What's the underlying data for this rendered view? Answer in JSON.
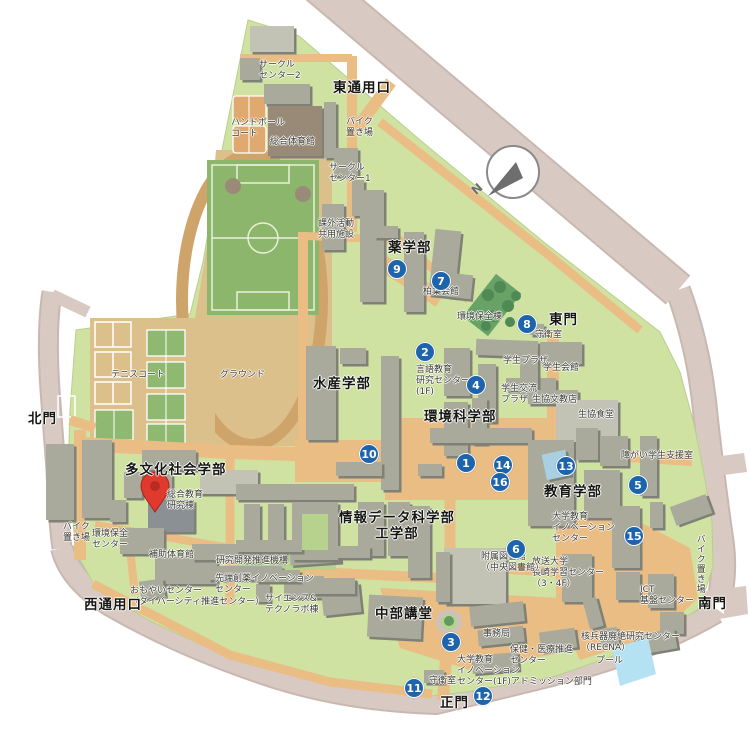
{
  "colors": {
    "campus_green": "#cfe2a2",
    "court_green": "#8fb971",
    "field_green": "#8cb66b",
    "tree_green": "#5f9a60",
    "path_orange": "#eabd84",
    "ground_tan": "#dcc08c",
    "track_tan": "#cfa46a",
    "road_pink": "#d8c9c2",
    "building_gray": "#a9aa9b",
    "marker_blue": "#1e64ad",
    "pin_red": "#e03a2f",
    "pool_blue": "#b5e2f2"
  },
  "compass": {
    "label": "N"
  },
  "pin": {
    "target": "総合教育研究棟"
  },
  "markers": [
    {
      "n": "1",
      "x": 466,
      "y": 463
    },
    {
      "n": "2",
      "x": 425,
      "y": 352
    },
    {
      "n": "3",
      "x": 451,
      "y": 642
    },
    {
      "n": "4",
      "x": 476,
      "y": 385
    },
    {
      "n": "5",
      "x": 638,
      "y": 485
    },
    {
      "n": "6",
      "x": 516,
      "y": 549
    },
    {
      "n": "7",
      "x": 441,
      "y": 281
    },
    {
      "n": "8",
      "x": 527,
      "y": 324
    },
    {
      "n": "9",
      "x": 397,
      "y": 269
    },
    {
      "n": "10",
      "x": 369,
      "y": 454
    },
    {
      "n": "11",
      "x": 414,
      "y": 688
    },
    {
      "n": "12",
      "x": 483,
      "y": 696
    },
    {
      "n": "13",
      "x": 566,
      "y": 466
    },
    {
      "n": "14",
      "x": 503,
      "y": 465
    },
    {
      "n": "15",
      "x": 634,
      "y": 536
    },
    {
      "n": "16",
      "x": 500,
      "y": 482
    }
  ],
  "labels": [
    {
      "name": "circle-center-2",
      "text": "サークル\nセンター2",
      "x": 259,
      "y": 60
    },
    {
      "name": "east-service-entrance",
      "text": "東通用口",
      "x": 333,
      "y": 80,
      "bold": true
    },
    {
      "name": "handball-court",
      "text": "ハンドボール\nコート",
      "x": 231,
      "y": 118
    },
    {
      "name": "general-gymnasium",
      "text": "総合体育館",
      "x": 270,
      "y": 137
    },
    {
      "name": "bike-parking-north",
      "text": "バイク\n置き場",
      "x": 346,
      "y": 117
    },
    {
      "name": "circle-center-1",
      "text": "サークル\nセンター1",
      "x": 329,
      "y": 163
    },
    {
      "name": "extracurricular-shared-bldg",
      "text": "課外活動\n共用施設",
      "x": 318,
      "y": 219
    },
    {
      "name": "pharmacy-faculty",
      "text": "薬学部",
      "x": 388,
      "y": 240,
      "bold": true
    },
    {
      "name": "hakuyo-hall",
      "text": "柏葉会館",
      "x": 423,
      "y": 287
    },
    {
      "name": "environment-preservation-bldg",
      "text": "環境保全棟",
      "x": 457,
      "y": 312
    },
    {
      "name": "east-gate",
      "text": "東門",
      "x": 549,
      "y": 312,
      "bold": true
    },
    {
      "name": "east-gate-guard",
      "text": "守衛室",
      "x": 535,
      "y": 330
    },
    {
      "name": "student-plaza",
      "text": "学生プラザ",
      "x": 503,
      "y": 356
    },
    {
      "name": "student-hall",
      "text": "学生会館",
      "x": 543,
      "y": 363
    },
    {
      "name": "student-exchange-plaza",
      "text": "学生交流\nプラザ",
      "x": 501,
      "y": 384
    },
    {
      "name": "coop-bunkyo-store",
      "text": "生協文教店",
      "x": 532,
      "y": 395
    },
    {
      "name": "coop-cafeteria",
      "text": "生協食堂",
      "x": 578,
      "y": 410
    },
    {
      "name": "disability-student-support",
      "text": "障がい学生支援室",
      "x": 621,
      "y": 451
    },
    {
      "name": "education-faculty",
      "text": "教育学部",
      "x": 544,
      "y": 484,
      "bold": true
    },
    {
      "name": "fisheries-faculty",
      "text": "水産学部",
      "x": 313,
      "y": 376,
      "bold": true
    },
    {
      "name": "language-education-center",
      "text": "言語教育\n研究センター\n(1F)",
      "x": 416,
      "y": 365
    },
    {
      "name": "environmental-science-faculty",
      "text": "環境科学部",
      "x": 424,
      "y": 409,
      "bold": true
    },
    {
      "name": "multicultural-faculty",
      "text": "多文化社会学部",
      "x": 125,
      "y": 462,
      "bold": true
    },
    {
      "name": "general-education-research-bldg",
      "text": "総合教育\n研究棟",
      "x": 167,
      "y": 490
    },
    {
      "name": "bike-parking-west",
      "text": "バイク\n置き場",
      "x": 63,
      "y": 522
    },
    {
      "name": "environment-preservation-center",
      "text": "環境保全\nセンター",
      "x": 92,
      "y": 529
    },
    {
      "name": "auxiliary-gymnasium",
      "text": "補助体育館",
      "x": 149,
      "y": 550
    },
    {
      "name": "rd-promotion-organization",
      "text": "研究開発推進機構",
      "x": 216,
      "y": 556
    },
    {
      "name": "advanced-drug-innovation-center",
      "text": "先端創薬イノベーション\nセンター",
      "x": 215,
      "y": 574
    },
    {
      "name": "omoyai-center",
      "text": "おもやいセンター\n（ダイバーシティ推進センター）",
      "x": 130,
      "y": 586
    },
    {
      "name": "west-service-entrance",
      "text": "西通用口",
      "x": 84,
      "y": 597,
      "bold": true
    },
    {
      "name": "science-technolab-bldg",
      "text": "サイエンス&\nテクノラボ棟",
      "x": 265,
      "y": 594
    },
    {
      "name": "infodata-engineering-faculty",
      "text": "情報データ科学部\n工学部",
      "x": 397,
      "y": 510,
      "bold": true,
      "center": true
    },
    {
      "name": "chubu-auditorium",
      "text": "中部講堂",
      "x": 375,
      "y": 606,
      "bold": true
    },
    {
      "name": "administration-office",
      "text": "事務局",
      "x": 483,
      "y": 629
    },
    {
      "name": "health-medical-center",
      "text": "保健・医療推進\nセンター",
      "x": 510,
      "y": 645
    },
    {
      "name": "innovation-admission-office",
      "text": "大学教育\nイノベーション\nセンター(1F)アドミッション部門",
      "x": 457,
      "y": 655
    },
    {
      "name": "recna-center",
      "text": "核兵器廃絶研究センター\n（RECNA）",
      "x": 581,
      "y": 632
    },
    {
      "name": "pool",
      "text": "プール",
      "x": 596,
      "y": 656
    },
    {
      "name": "ict-infrastructure-center",
      "text": "ICT\n基盤センター",
      "x": 640,
      "y": 585
    },
    {
      "name": "south-gate",
      "text": "南門",
      "x": 698,
      "y": 596,
      "bold": true
    },
    {
      "name": "bike-parking-south",
      "text": "バイク置き場",
      "x": 694,
      "y": 534,
      "vertical": true
    },
    {
      "name": "main-gate-guard",
      "text": "守衛室",
      "x": 429,
      "y": 676
    },
    {
      "name": "main-gate",
      "text": "正門",
      "x": 440,
      "y": 695,
      "bold": true
    },
    {
      "name": "univ-education-innovation-center",
      "text": "大学教育\nイノベーション\nセンター",
      "x": 552,
      "y": 512
    },
    {
      "name": "open-university-nagasaki-center",
      "text": "放送大学\n長崎学習センター\n（3・4F）",
      "x": 532,
      "y": 557
    },
    {
      "name": "central-library",
      "text": "附属図書館\n（中央図書館）",
      "x": 481,
      "y": 552
    },
    {
      "name": "ground",
      "text": "グラウンド",
      "x": 220,
      "y": 370
    },
    {
      "name": "tennis-court",
      "text": "テニスコート",
      "x": 111,
      "y": 370
    },
    {
      "name": "north-gate",
      "text": "北門",
      "x": 28,
      "y": 411,
      "bold": true
    }
  ]
}
